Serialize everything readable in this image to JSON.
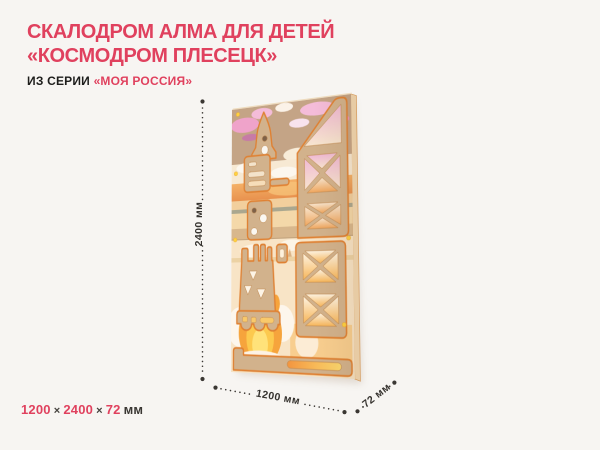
{
  "page": {
    "background_color": "#f7f5f2",
    "accent_color": "#e0415e",
    "text_color": "#1d1d1b",
    "dimension_line_color": "#3b3733"
  },
  "header": {
    "title_line1": "СКАЛОДРОМ АЛМА ДЛЯ ДЕТЕЙ",
    "title_line2": "«КОСМОДРОМ ПЛЕСЕЦК»",
    "series_prefix": "ИЗ СЕРИИ",
    "series_name": "«МОЯ РОССИЯ»"
  },
  "render": {
    "subject": "plywood-climbing-wall-rocket-launchpad-3d-render",
    "height_label": "2400 мм",
    "width_label": "1200 мм",
    "depth_label": "72 мм",
    "board_colors": {
      "plywood": "#d2b28c",
      "edge_outline": "#df8133",
      "bolt_yellow": "#ffd23f",
      "art_sky_kraft": "#c4a486",
      "art_cloud_pink": "#ee9fc6",
      "art_sunset_orange": "#f0a55c",
      "art_flame_yellow": "#fcc94e"
    }
  },
  "footer": {
    "width_value": "1200",
    "sep1": "×",
    "height_value": "2400",
    "sep2": "×",
    "depth_value": "72",
    "unit": "мм"
  }
}
